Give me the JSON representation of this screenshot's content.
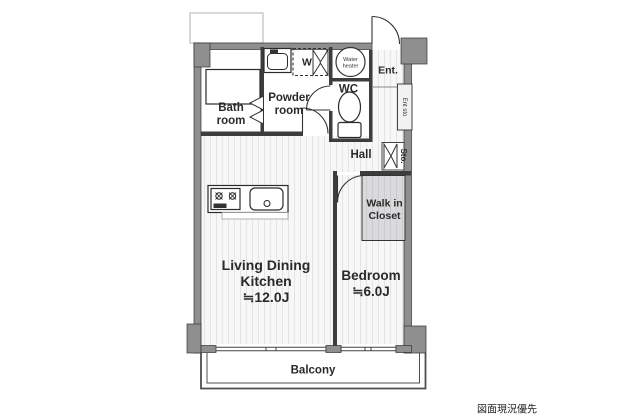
{
  "rooms": {
    "bath": {
      "l1": "Bath",
      "l2": "room"
    },
    "powder": {
      "l1": "Powder",
      "l2": "room"
    },
    "washer": "W",
    "water_heater": {
      "l1": "Water",
      "l2": "heater"
    },
    "entrance": "Ent.",
    "wc": "WC",
    "entrance_storage": "Ent sto",
    "hall": "Hall",
    "storage": "Sto.",
    "walk_in_closet": {
      "l1": "Walk in",
      "l2": "Closet"
    },
    "ldk": {
      "l1": "Living Dining",
      "l2": "Kitchen",
      "size": "≒12.0J"
    },
    "bedroom": {
      "name": "Bedroom",
      "size": "≒6.0J"
    },
    "balcony": "Balcony"
  },
  "note": "図面現況優先",
  "colors": {
    "wall": "#8f8f8f",
    "wall_edge": "#333333",
    "interior_wall": "#3d3d3d",
    "floor_stripe_bg": "#f7f7f8",
    "floor_stripe_line": "#e6e6e8",
    "wic_fill": "#dadadc",
    "label": "#2a2a2a"
  }
}
